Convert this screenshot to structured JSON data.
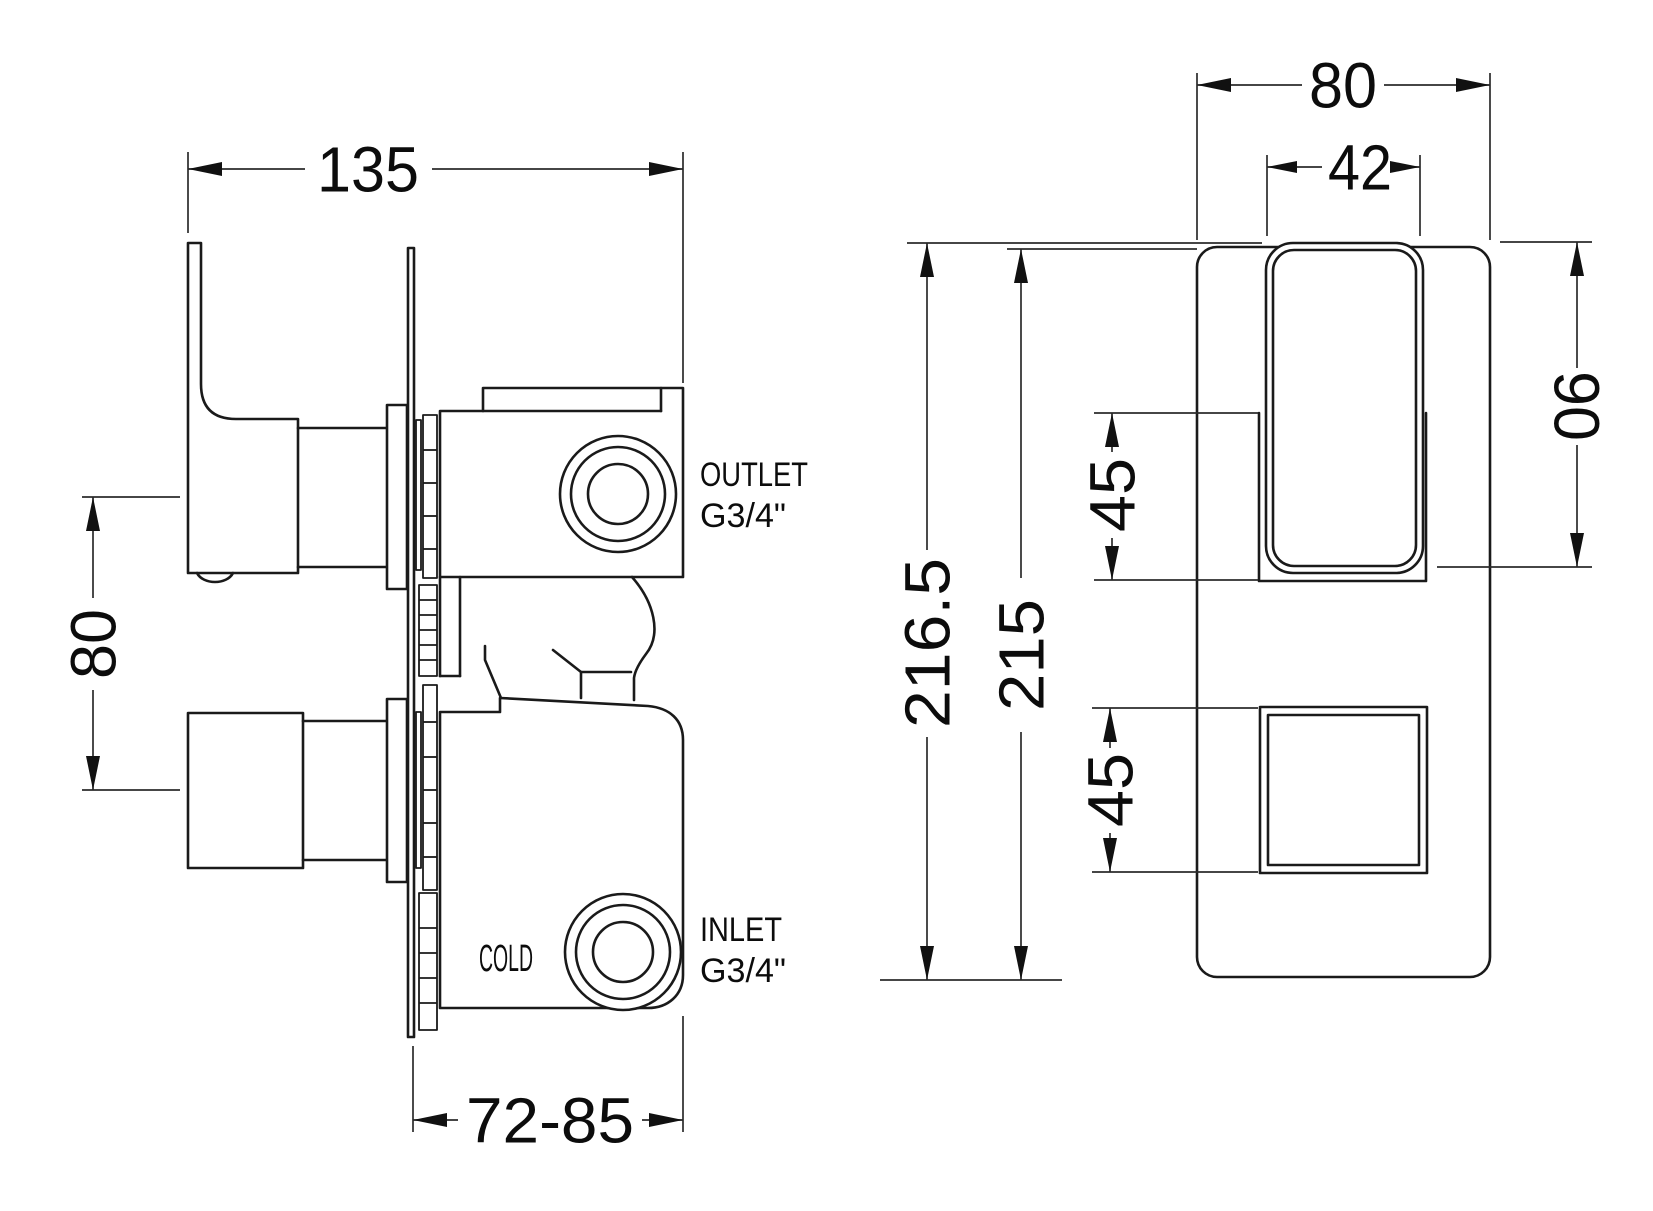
{
  "drawing_title": "Concealed thermostatic shower valve - dimensioned technical drawing",
  "colors": {
    "line": "#1a1a1a",
    "background": "#ffffff"
  },
  "left_view": {
    "dim_width": "135",
    "dim_handle_centres": "80",
    "dim_install_depth": "72-85",
    "outlet_line1": "OUTLET",
    "outlet_line2": "G3/4\"",
    "inlet_line1": "INLET",
    "inlet_line2": "G3/4\"",
    "cold": "COLD"
  },
  "front_view": {
    "dim_plate_width": "80",
    "dim_handle_width": "42",
    "dim_overall_height": "216.5",
    "dim_plate_height": "215",
    "dim_recess_height": "45",
    "dim_button_height": "45",
    "dim_handle_height": "90"
  }
}
